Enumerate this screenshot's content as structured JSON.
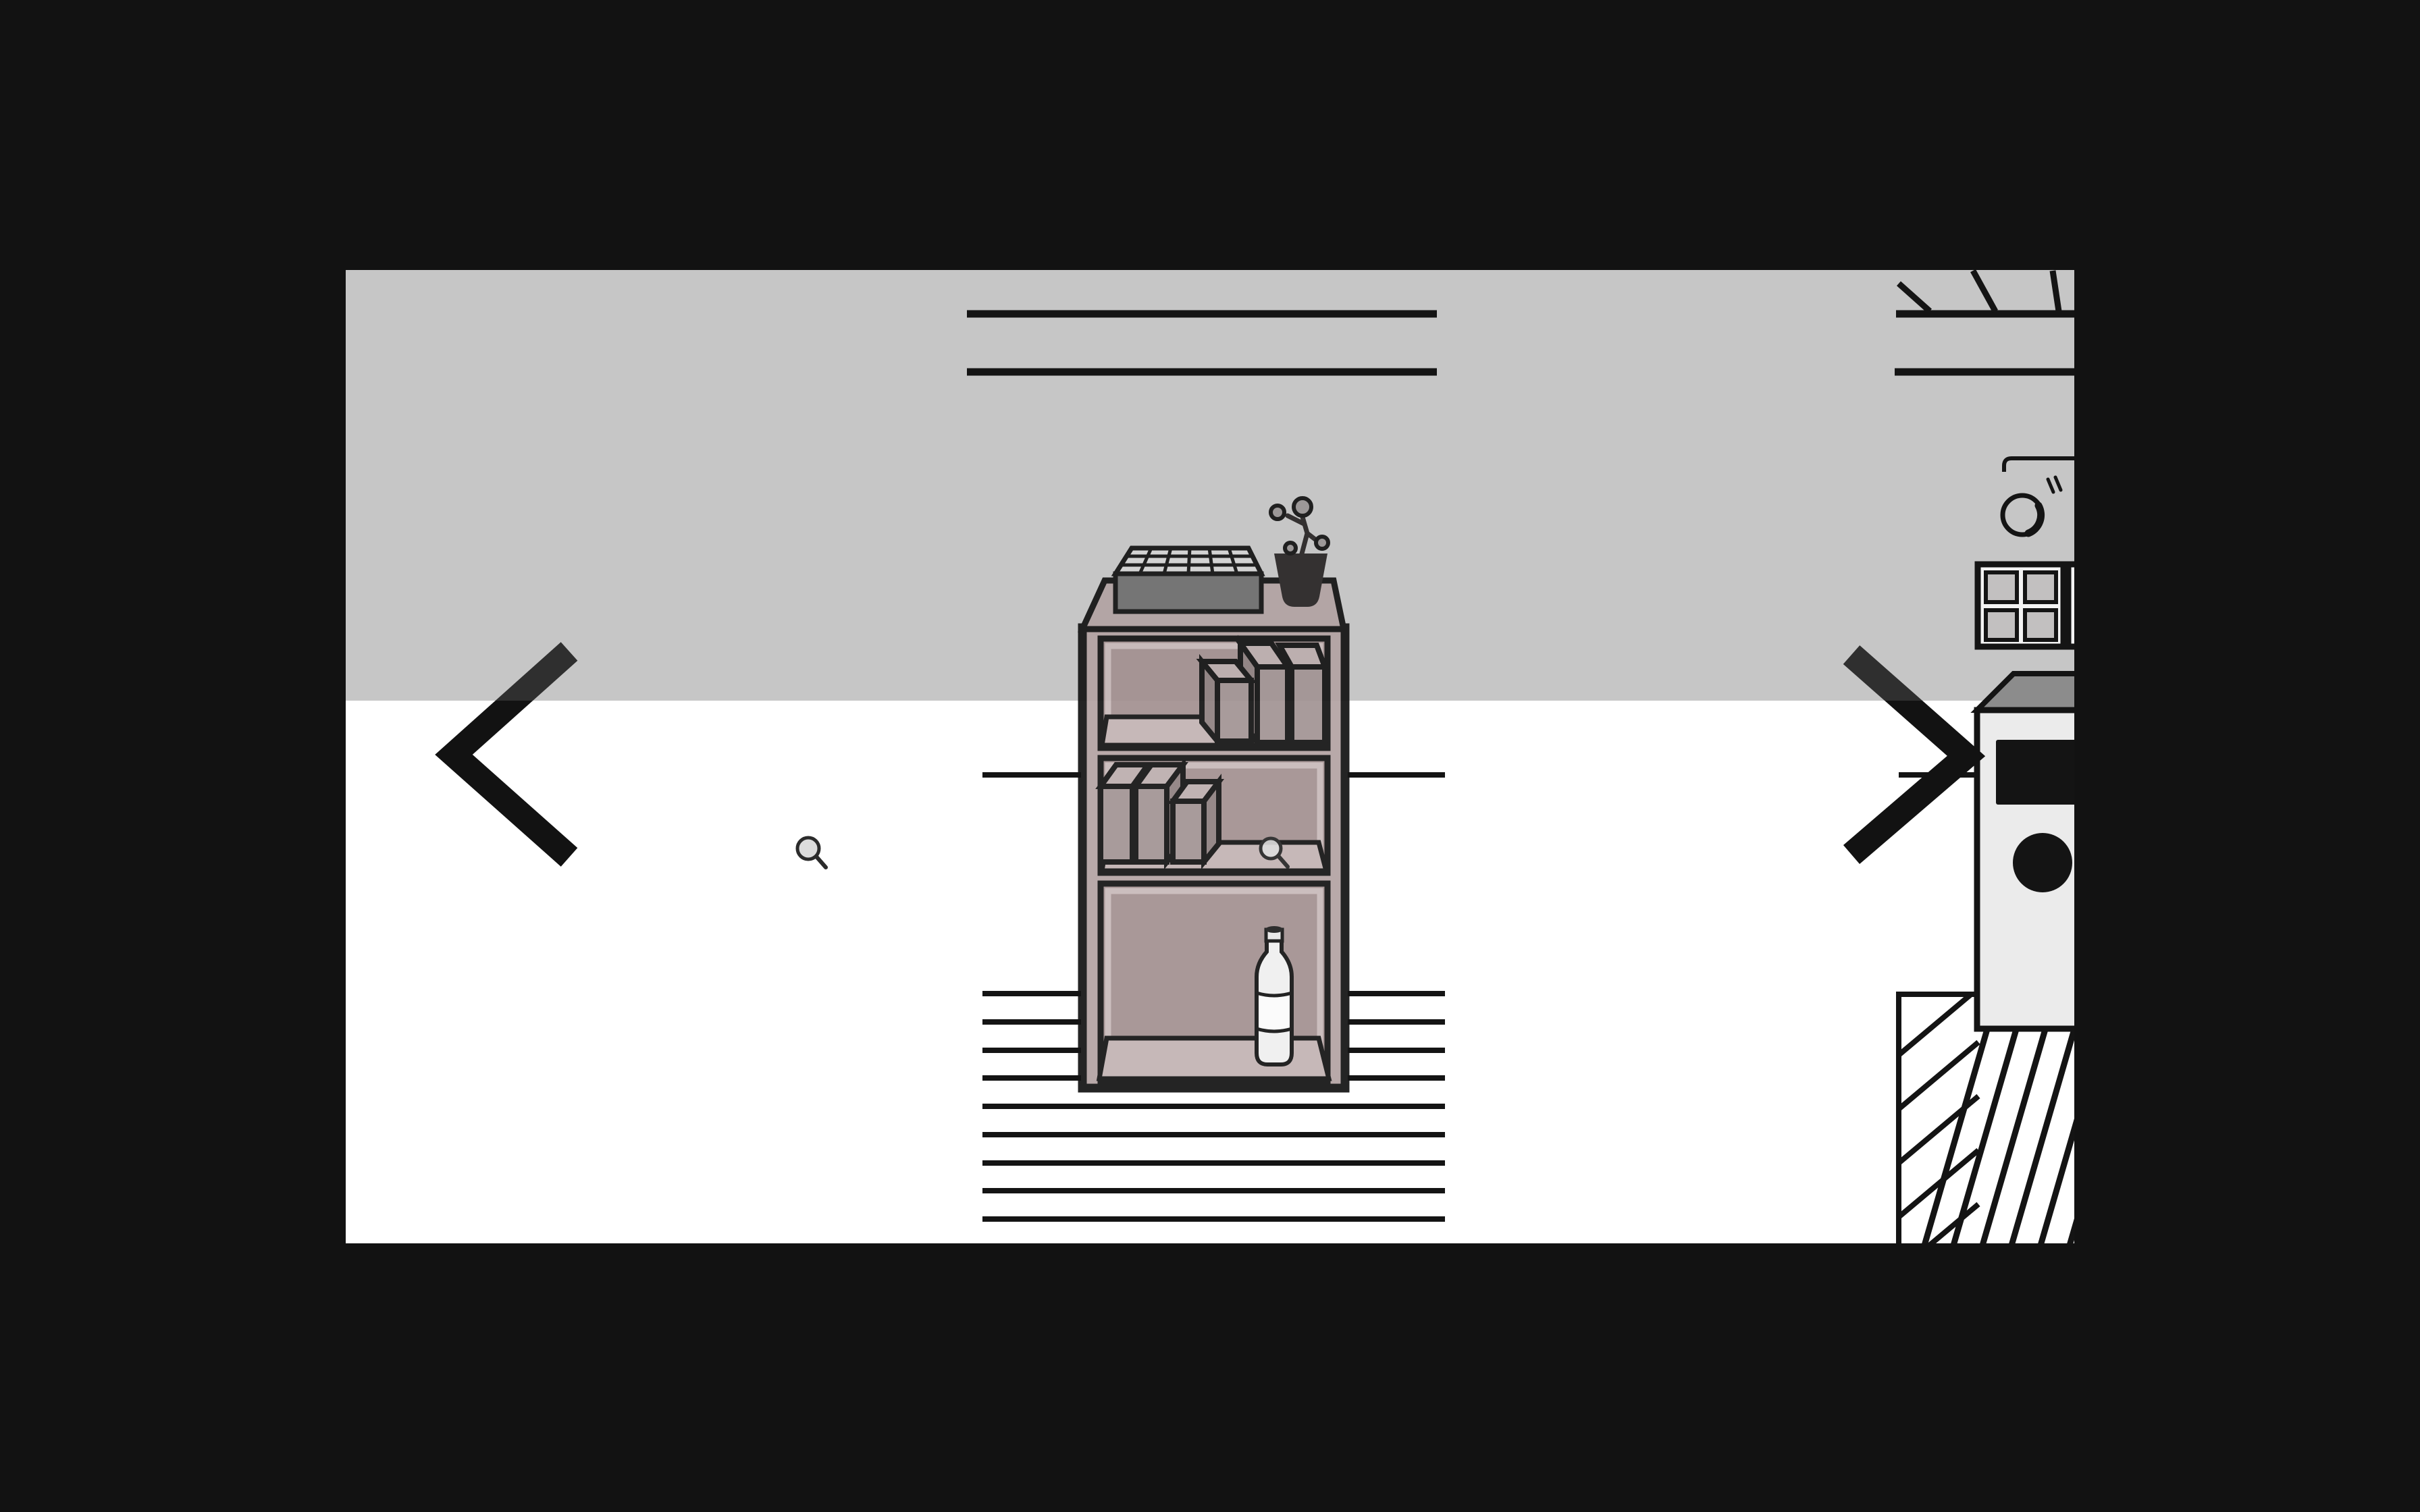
{
  "app": {
    "name": "room-explorer-game",
    "view": "kitchen-wall-scene"
  },
  "nav": {
    "prev_label": "previous view",
    "next_label": "next view"
  },
  "hotspots": {
    "floor_magnifier_label": "inspect floor area",
    "shelf_magnifier_label": "inspect shelf compartment",
    "shelf_label": "storage shelf",
    "bottle_label": "bottle",
    "crate_label": "storage crate",
    "plant_label": "potted plant",
    "appliance_label": "kitchen appliance",
    "window_label": "small window"
  },
  "colors": {
    "outside": "#121212",
    "wall": "#c6c6c6",
    "floor": "#ffffff",
    "ink": "#141414",
    "shelfFrame": "#b3a3a3",
    "shelfTint": "#a39191",
    "shelfFloor": "#c2b3b3",
    "rim": "#c8baba",
    "tabletop": "#b2a3a3",
    "boxFront": "#a29494",
    "boxTop": "#bcaeae",
    "boxSide": "#8f8181",
    "crateFront": "#6f6f6f",
    "crateTop": "#d5d5d5",
    "pot": "#2a2626",
    "plantCircle": "#999595",
    "bottleBody": "#efefef",
    "bottleWhite": "#fbfbfb",
    "capTop": "#1f1f1f",
    "applianceBody": "#ebebeb",
    "applianceTop": "#8c8c8c",
    "pane": "#c2c0c0",
    "mullion": "#f3f3f3",
    "chevron": "#121212",
    "lens": "#dcdcdc"
  }
}
